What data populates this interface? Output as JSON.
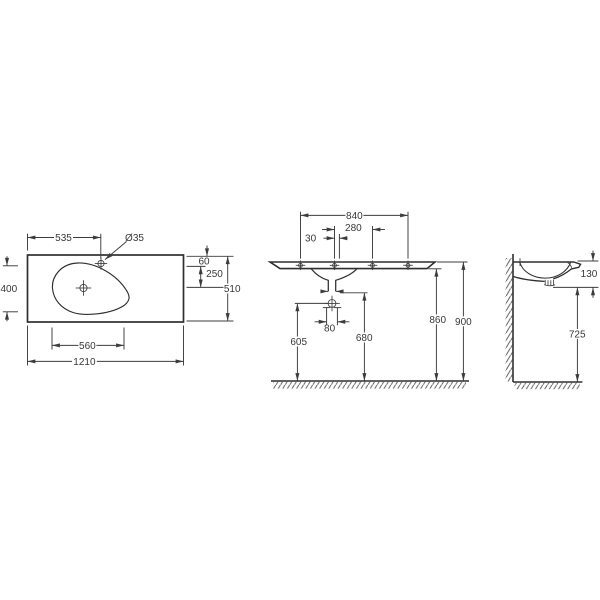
{
  "page": {
    "background": "#ffffff"
  },
  "drawing": {
    "type": "technical-dimension-drawing",
    "subject": "vanity washbasin with countertop",
    "line_color": "#3c3c3c",
    "text_color": "#383838",
    "views": {
      "plan": {
        "dims": {
          "faucet_from_left": "535",
          "faucet_hole_dia": "Ø35",
          "bowl_depth": "400",
          "bowl_width": "560",
          "overall_width": "1210",
          "back_edge_to_faucet": "60",
          "faucet_to_drain": "250",
          "overall_depth": "510"
        }
      },
      "front": {
        "dims": {
          "fixing_holes_span": "840",
          "fixing_holes_inner": "280",
          "axis_offset": "30",
          "trap_fixing_width": "80",
          "floor_to_trap": "605",
          "floor_to_drain_outlet": "680",
          "floor_to_underside": "860",
          "floor_to_rim": "900"
        }
      },
      "side": {
        "dims": {
          "basin_front_height": "130",
          "floor_to_basin_underside": "725"
        }
      }
    }
  }
}
